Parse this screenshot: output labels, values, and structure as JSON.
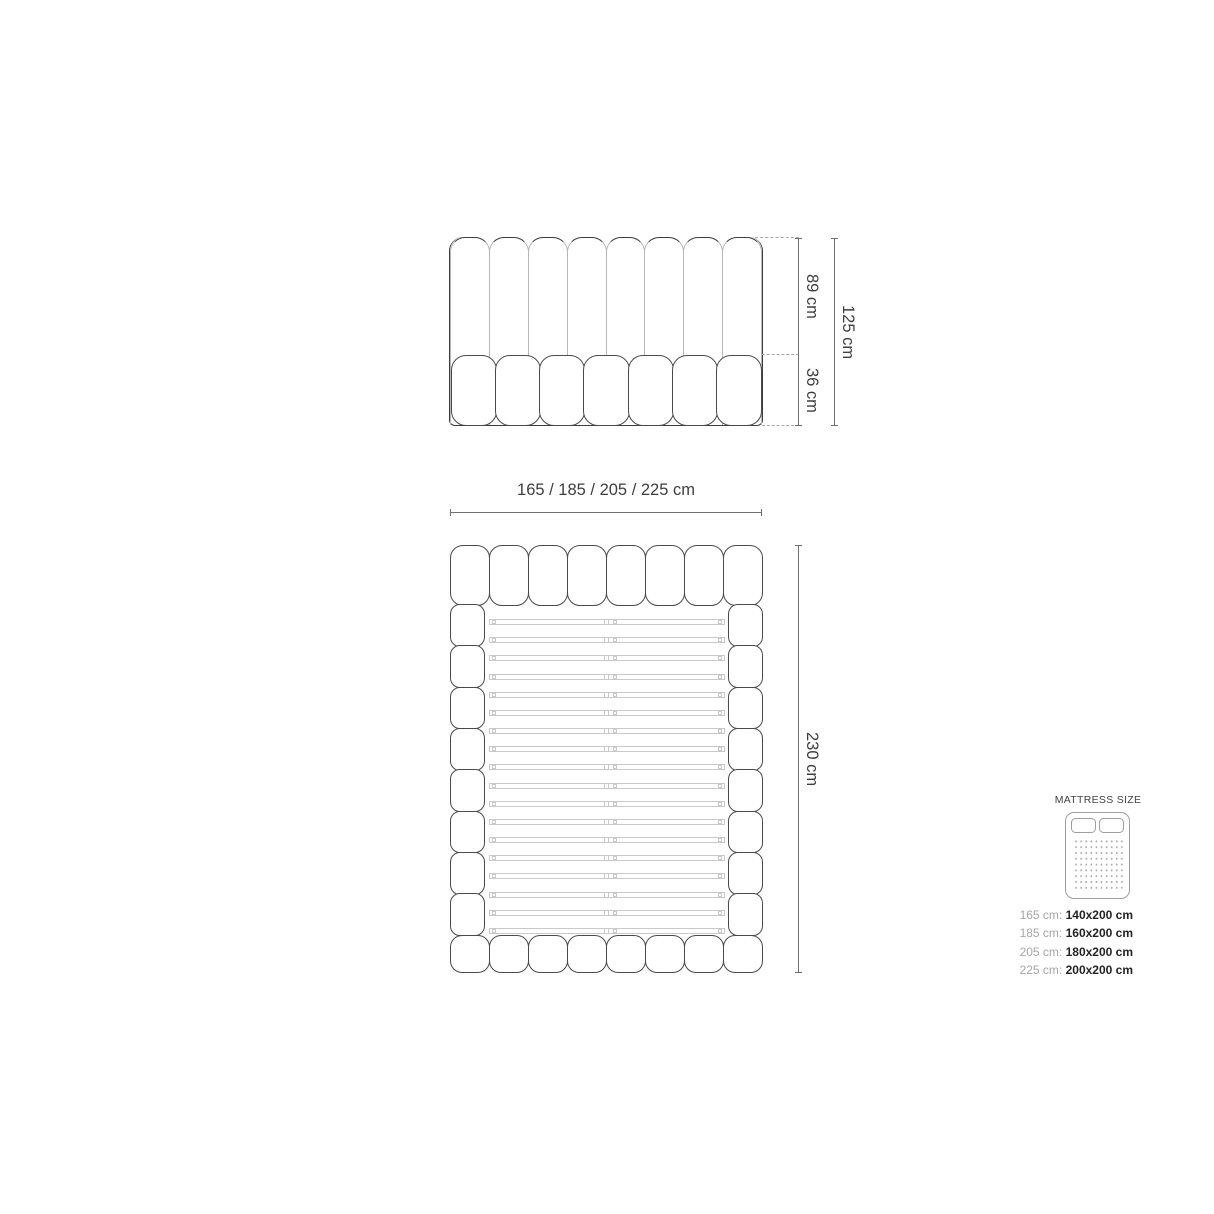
{
  "front_view": {
    "dim_height_upper": "89 cm",
    "dim_height_lower": "36 cm",
    "dim_height_total": "125 cm",
    "width_label": "165 / 185 / 205 / 225 cm",
    "headboard_channels": 8,
    "base_cushions": 7
  },
  "plan_view": {
    "dim_length": "230 cm",
    "header_cushions": 8,
    "footer_cushions": 8,
    "side_rail_segments": 8,
    "slat_count": 18
  },
  "legend": {
    "title": "MATTRESS SIZE",
    "rows": [
      {
        "width": "165 cm:",
        "mattress": "140x200 cm"
      },
      {
        "width": "185 cm:",
        "mattress": "160x200 cm"
      },
      {
        "width": "205 cm:",
        "mattress": "180x200 cm"
      },
      {
        "width": "225 cm:",
        "mattress": "200x200 cm"
      }
    ]
  },
  "colors": {
    "outline": "#3d3d3d",
    "inner_line": "#b7b7b7",
    "slat_line": "#c9c9c9",
    "dimension_line": "#6e6e6e",
    "text": "#3e3e3e",
    "legend_label": "#a6a6a6",
    "legend_value": "#232323",
    "background": "#ffffff"
  }
}
